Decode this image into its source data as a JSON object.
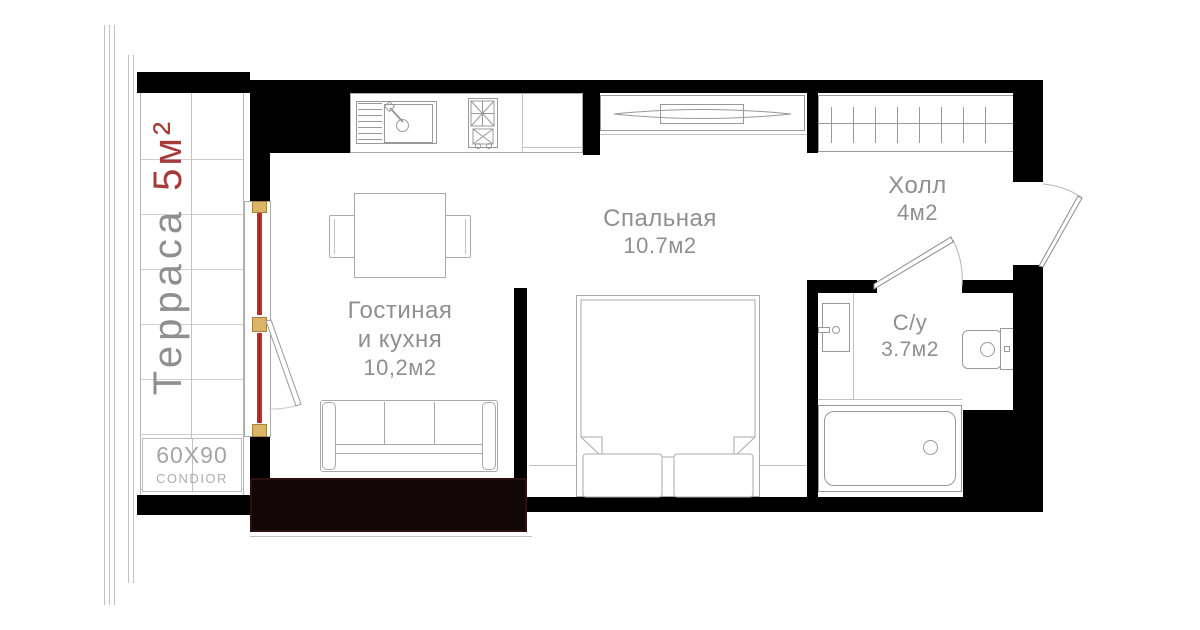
{
  "rooms": {
    "terrace": {
      "name": "Терраса",
      "area": "5м²"
    },
    "living": {
      "name_line1": "Гостиная",
      "name_line2": "и кухня",
      "area": "10,2м2"
    },
    "bedroom": {
      "name": "Спальная",
      "area": "10.7м2"
    },
    "hall": {
      "name": "Холл",
      "area": "4м2"
    },
    "bathroom": {
      "name": "С/у",
      "area": "3.7м2"
    }
  },
  "annotations": {
    "tile_size": "60X90",
    "tile_brand": "CONDIOR"
  },
  "colors": {
    "wall": "#000000",
    "floor_slab_accent": "#120505",
    "terrace_area_red": "#a43c3c",
    "glazing_red": "#c53030",
    "frame_yellow": "#dcb468",
    "label_gray": "#8f8f8f",
    "line_gray": "#a8a8a8"
  }
}
